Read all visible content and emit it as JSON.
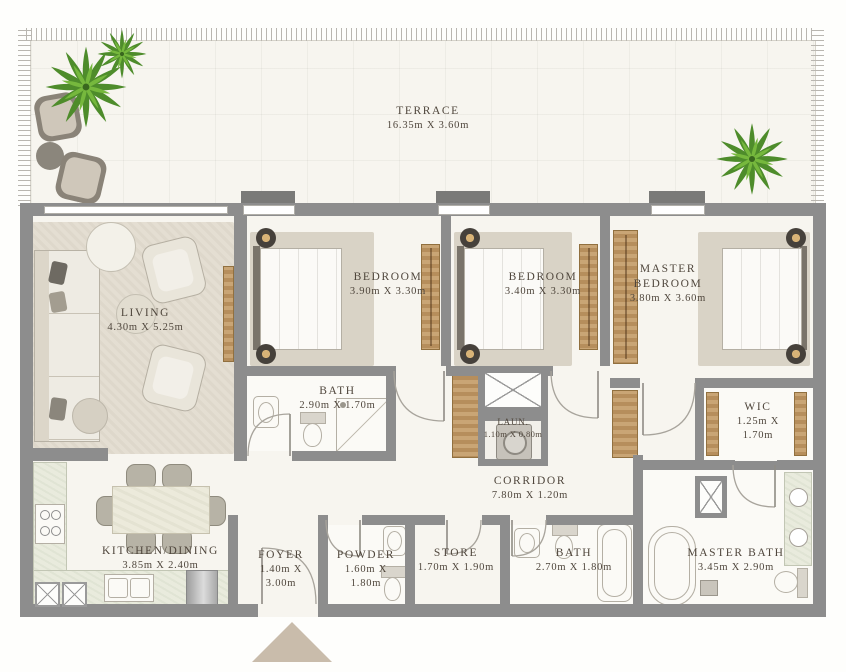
{
  "plan_type": "apartment-floor-plan",
  "colors": {
    "wall": "#8d8d8d",
    "floor": "#f7f5ef",
    "wood": "#bb9264",
    "rug": "#e4ded2",
    "entrance_marker": "#c9bcab",
    "label_text": "#4f463c",
    "plant_dark": "#4e8c2b",
    "plant_light": "#76b83d"
  },
  "rooms": [
    {
      "id": "terrace",
      "name": "TERRACE",
      "dims": "16.35m X 3.60m"
    },
    {
      "id": "living",
      "name": "LIVING",
      "dims": "4.30m X 5.25m"
    },
    {
      "id": "bedroom1",
      "name": "BEDROOM",
      "dims": "3.90m X 3.30m"
    },
    {
      "id": "bedroom2",
      "name": "BEDROOM",
      "dims": "3.40m X 3.30m"
    },
    {
      "id": "master-bedroom",
      "name": "MASTER BEDROOM",
      "dims": "3.80m X 3.60m"
    },
    {
      "id": "bath1",
      "name": "BATH",
      "dims": "2.90m X 1.70m"
    },
    {
      "id": "laundry",
      "name": "LAUN.",
      "dims": "1.10m X 0.80m"
    },
    {
      "id": "wic",
      "name": "WIC",
      "dims": "1.25m X 1.70m"
    },
    {
      "id": "corridor",
      "name": "CORRIDOR",
      "dims": "7.80m X 1.20m"
    },
    {
      "id": "kitchen-dining",
      "name": "KITCHEN/DINING",
      "dims": "3.85m X 2.40m"
    },
    {
      "id": "foyer",
      "name": "FOYER",
      "dims": "1.40m X 3.00m"
    },
    {
      "id": "powder",
      "name": "POWDER",
      "dims": "1.60m X 1.80m"
    },
    {
      "id": "store",
      "name": "STORE",
      "dims": "1.70m X 1.90m"
    },
    {
      "id": "bath2",
      "name": "BATH",
      "dims": "2.70m X 1.80m"
    },
    {
      "id": "master-bath",
      "name": "MASTER BATH",
      "dims": "3.45m X 2.90m"
    }
  ]
}
